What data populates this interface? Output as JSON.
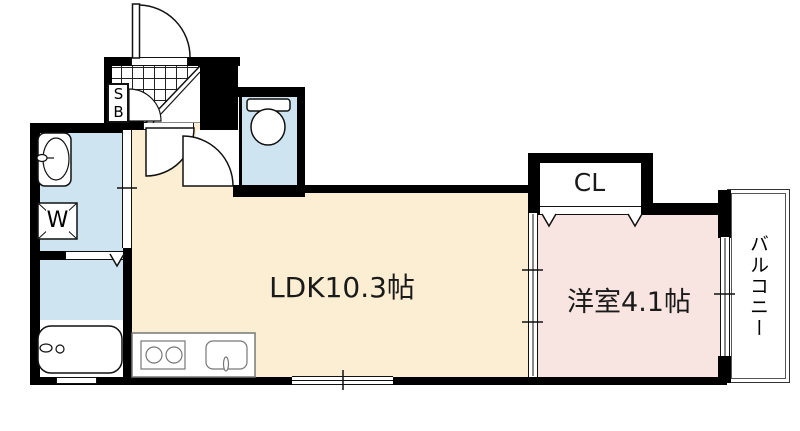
{
  "floorplan": {
    "rooms": {
      "ldk": {
        "label": "LDK10.3帖"
      },
      "bedroom": {
        "label": "洋室4.1帖"
      },
      "closet": {
        "label": "CL"
      },
      "balcony": {
        "label": "バルコニー"
      },
      "shoebox": {
        "label": "SB"
      },
      "washer": {
        "label": "W"
      }
    },
    "colors": {
      "ldk_floor": "#FBEED3",
      "bedroom_floor": "#F8E5E1",
      "wet_area_floor": "#CEE4F1",
      "wall": "#000000",
      "kitchen_outline": "#777777"
    }
  }
}
